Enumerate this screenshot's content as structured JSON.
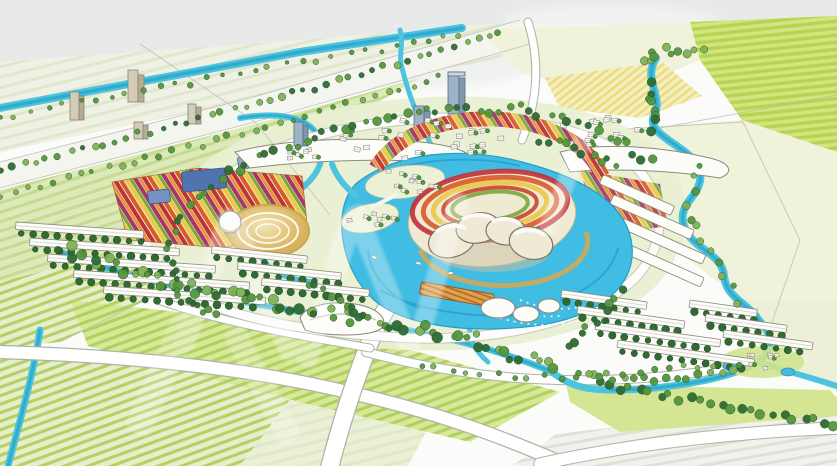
{
  "image": {
    "kind": "hand-drawn watercolor aerial masterplan rendering",
    "description": "Aerial watercolor illustration of a planned lakeside township: a central turquoise lake with an island cultural center ringed by red, orange and yellow flower terraces, surrounded by townhouse rows, apartment blocks, towers, tree-lined canals and striped green farm fields",
    "elements": [
      "sky-wash-band",
      "striped-farm-fields",
      "irrigation-canals",
      "meandering-river",
      "central-lake",
      "island-cultural-center",
      "flower-terraces",
      "flower-garden-strips",
      "circular-sand-plaza",
      "dome-pavilion",
      "townhouse-rows",
      "apartment-blocks",
      "high-rise-towers",
      "tree-belts",
      "village-house-clusters",
      "boardwalk-pier",
      "resort-cluster",
      "white-watermark-strokes"
    ]
  },
  "palette": {
    "paper": "#fbfcf9",
    "sky_wash": "#e7eae8",
    "sky_wash2": "#f2f4f2",
    "field_pale": "#eff1e4",
    "field_light": "#e7eec9",
    "field_mid": "#dce9b8",
    "field_bright": "#d4e694",
    "field_lime": "#d3e57c",
    "field_yellow": "#f4eec2",
    "field_cream": "#f0f2da",
    "field_gray": "#f1f2ec",
    "stripe_pale": "#dfe5cb",
    "stripe_mid": "#c4d78b",
    "stripe_bright": "#a9cc57",
    "stripe_lime": "#b0d14e",
    "stripe_yellow": "#e9d96b",
    "stripe_gray": "#dcded6",
    "site_base": "#e9efd2",
    "meadow": "#d7e897",
    "canal": "#4cc4de",
    "canal_deep": "#239fc6",
    "lake": "#41bce2",
    "lake_deep": "#1d92c6",
    "tree_dark": "#2f6b33",
    "tree_mid": "#55953d",
    "tree_light": "#7fb355",
    "flower_red": "#c03038",
    "flower_rust": "#d85a28",
    "flower_orange": "#e8933a",
    "flower_yellow": "#ecc84a",
    "flower_olive": "#7aa83c",
    "flower_magenta": "#a83468",
    "building_white": "#fcfcf9",
    "building_cream": "#efe9d6",
    "building_shadow": "#c9c0a4",
    "building_outline": "#8d897c",
    "tower_tan": "#d3ccb8",
    "tower_tan_side": "#b4ac94",
    "tower_blue": "#9db4c8",
    "tower_blue_side": "#7e98b0",
    "roof_blue": "#4f74b0",
    "roof_blue2": "#7292c2",
    "plaza_sand": "#f3e6b4",
    "plaza_gold": "#d9b25c",
    "pier_wood": "#e0a050",
    "pier_dark": "#b06a20",
    "road_white": "#ffffff",
    "road_edge": "#aeb2a6",
    "sketch_line": "#b7bbb0",
    "watermark": "#ffffff"
  }
}
